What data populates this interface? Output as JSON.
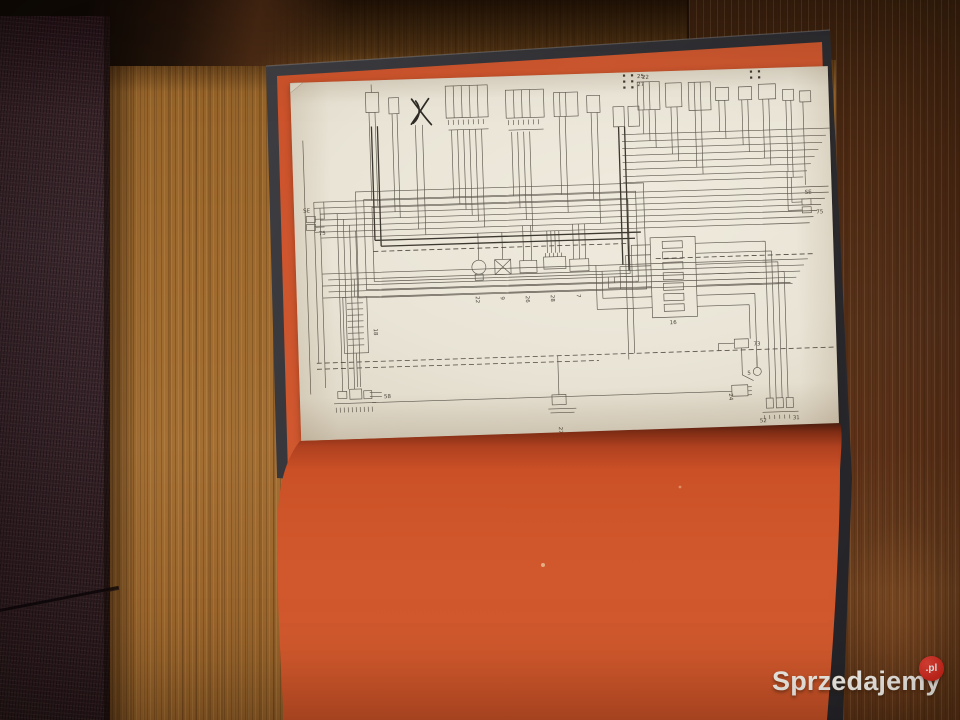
{
  "watermark": {
    "brand": "Sprzedajemy",
    "tld": ".pl"
  },
  "palette": {
    "endpaper_orange": "#d0572b",
    "page_cream": "#e9e4d6",
    "cover_charcoal": "#37373b",
    "table_wood": "#9f6a2e",
    "dark_plank": "#57311a",
    "sofa_fabric": "#38252b",
    "watermark_badge_red": "#d8291d",
    "diagram_ink": "#5b554c"
  },
  "diagram": {
    "kind": "vehicle wiring schematic printed on book plate",
    "labels": [
      {
        "t": "25",
        "x": 347,
        "y": 6,
        "r": 0
      },
      {
        "t": "27",
        "x": 347,
        "y": 14,
        "r": 0
      },
      {
        "t": "22",
        "x": 352,
        "y": 7,
        "r": 0
      },
      {
        "t": "16",
        "x": 372,
        "y": 253,
        "r": 0
      },
      {
        "t": "58",
        "x": 84,
        "y": 318,
        "r": 0
      },
      {
        "t": "24",
        "x": 429,
        "y": 324,
        "r": 90
      },
      {
        "t": "52",
        "x": 459,
        "y": 354,
        "r": 0
      },
      {
        "t": "31",
        "x": 492,
        "y": 352,
        "r": 0
      },
      {
        "t": "5",
        "x": 448,
        "y": 306,
        "r": 0
      },
      {
        "t": "73",
        "x": 455,
        "y": 277,
        "r": 0
      },
      {
        "t": "SE",
        "x": 9,
        "y": 130,
        "r": 0
      },
      {
        "t": "75",
        "x": 24,
        "y": 153,
        "r": 0
      },
      {
        "t": "SE",
        "x": 511,
        "y": 127,
        "r": 0
      },
      {
        "t": "75",
        "x": 522,
        "y": 147,
        "r": 0
      },
      {
        "t": "18",
        "x": 76,
        "y": 248,
        "r": 90
      },
      {
        "t": "27",
        "x": 258,
        "y": 352,
        "r": 90
      },
      {
        "t": "22",
        "x": 179,
        "y": 219,
        "r": 90
      },
      {
        "t": "9",
        "x": 204,
        "y": 220,
        "r": 90
      },
      {
        "t": "26",
        "x": 229,
        "y": 220,
        "r": 90
      },
      {
        "t": "28",
        "x": 254,
        "y": 220,
        "r": 90
      },
      {
        "t": "7",
        "x": 280,
        "y": 220,
        "r": 90
      }
    ]
  }
}
